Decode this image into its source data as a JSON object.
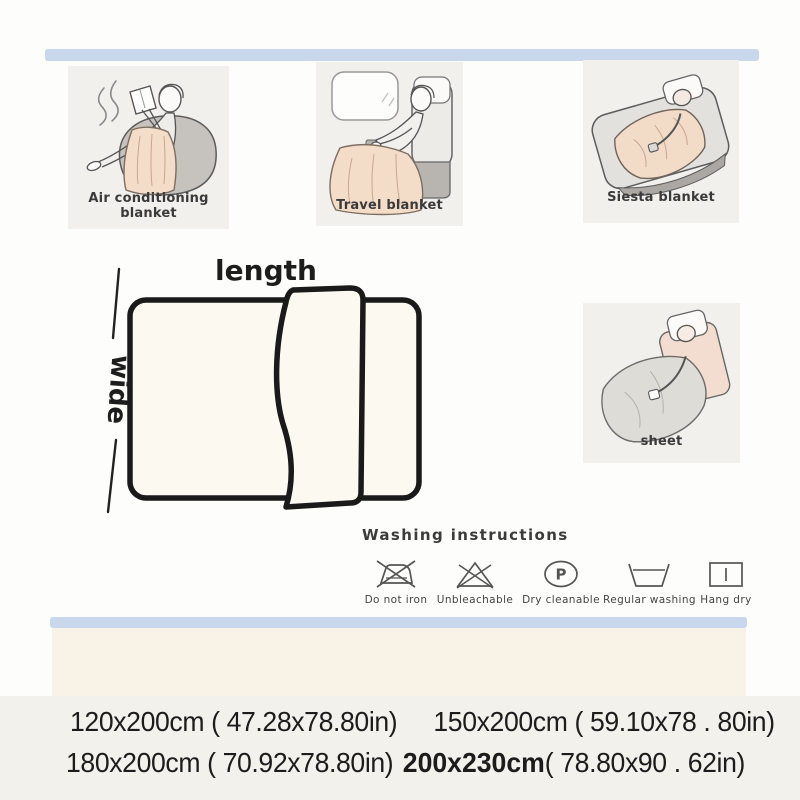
{
  "colors": {
    "strip_blue": "#c9d7ec",
    "panel_gray": "#f1f0ed",
    "cream_band": "#f8f3e6",
    "blanket_peach": "#f3dcc8",
    "sheet_gray": "#dedcd7",
    "outline_dark": "#1a1a1a",
    "text_dark": "#1c1c1c"
  },
  "scenes": {
    "air": {
      "label": "Air conditioning blanket"
    },
    "travel": {
      "label": "Travel blanket"
    },
    "siesta": {
      "label": "Siesta blanket"
    },
    "sheet": {
      "label": "sheet"
    }
  },
  "diagram": {
    "length": "length",
    "wide": "wide"
  },
  "washing": {
    "title": "Washing instructions",
    "dry_letter": "P",
    "items": [
      {
        "name": "do-not-iron",
        "label": "Do not iron"
      },
      {
        "name": "unbleachable",
        "label": "Unbleachable"
      },
      {
        "name": "dry-cleanable",
        "label": "Dry cleanable"
      },
      {
        "name": "regular-washing",
        "label": "Regular washing"
      },
      {
        "name": "hang-dry",
        "label": "Hang dry"
      }
    ]
  },
  "sizes": {
    "row1": [
      {
        "text": "120x200cm ( 47.28x78.80in)"
      },
      {
        "text": "150x200cm ( 59.10x78 . 80in)"
      }
    ],
    "row2_a": "180x200cm ( 70.92x78.80in)",
    "row2_b": "200x230cm",
    "row2_c": "( 78.80x90 . 62in)"
  }
}
